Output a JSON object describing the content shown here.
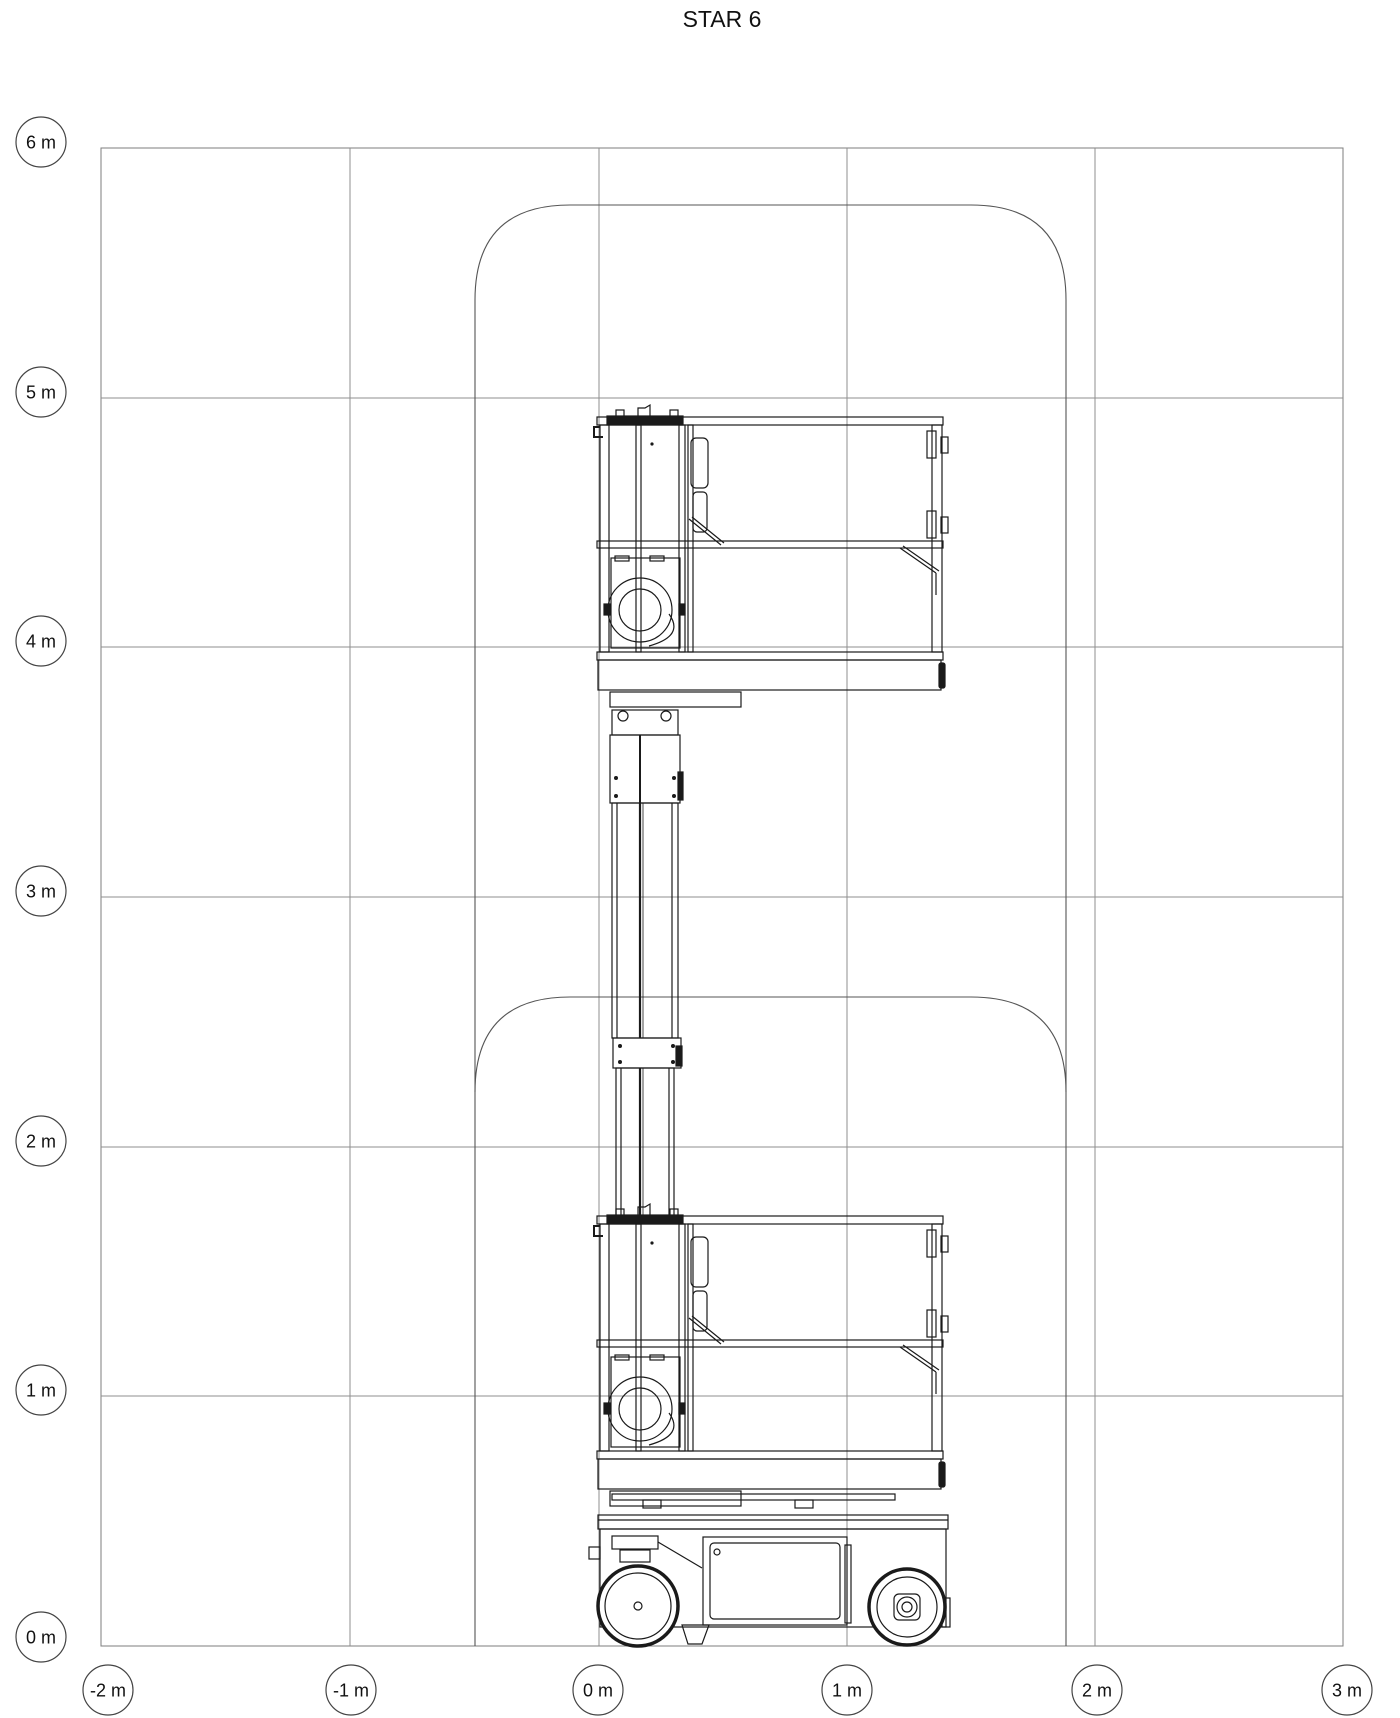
{
  "title": "STAR 6",
  "y_axis": {
    "unit": "m",
    "labels": [
      "6 m",
      "5 m",
      "4 m",
      "3 m",
      "2 m",
      "1 m",
      "0 m"
    ]
  },
  "x_axis": {
    "unit": "m",
    "labels": [
      "-2 m",
      "-1 m",
      "0 m",
      "1 m",
      "2 m",
      "3 m"
    ]
  },
  "diagram": {
    "type": "working-envelope-elevation-view",
    "machine": "vertical mast lift",
    "model": "STAR 6",
    "grid_interval_m": 1,
    "x_range_m": [
      -2,
      3
    ],
    "y_range_m": [
      0,
      6
    ],
    "positions_shown": [
      "stowed",
      "elevated"
    ],
    "envelope": {
      "x_min_m": -0.5,
      "x_max_m": 1.9,
      "top_elevated_m": 5.8,
      "top_stowed_m": 2.6
    },
    "line_color": "#1a1a1a",
    "grid_color": "#8f8f8f",
    "envelope_color": "#555555"
  }
}
